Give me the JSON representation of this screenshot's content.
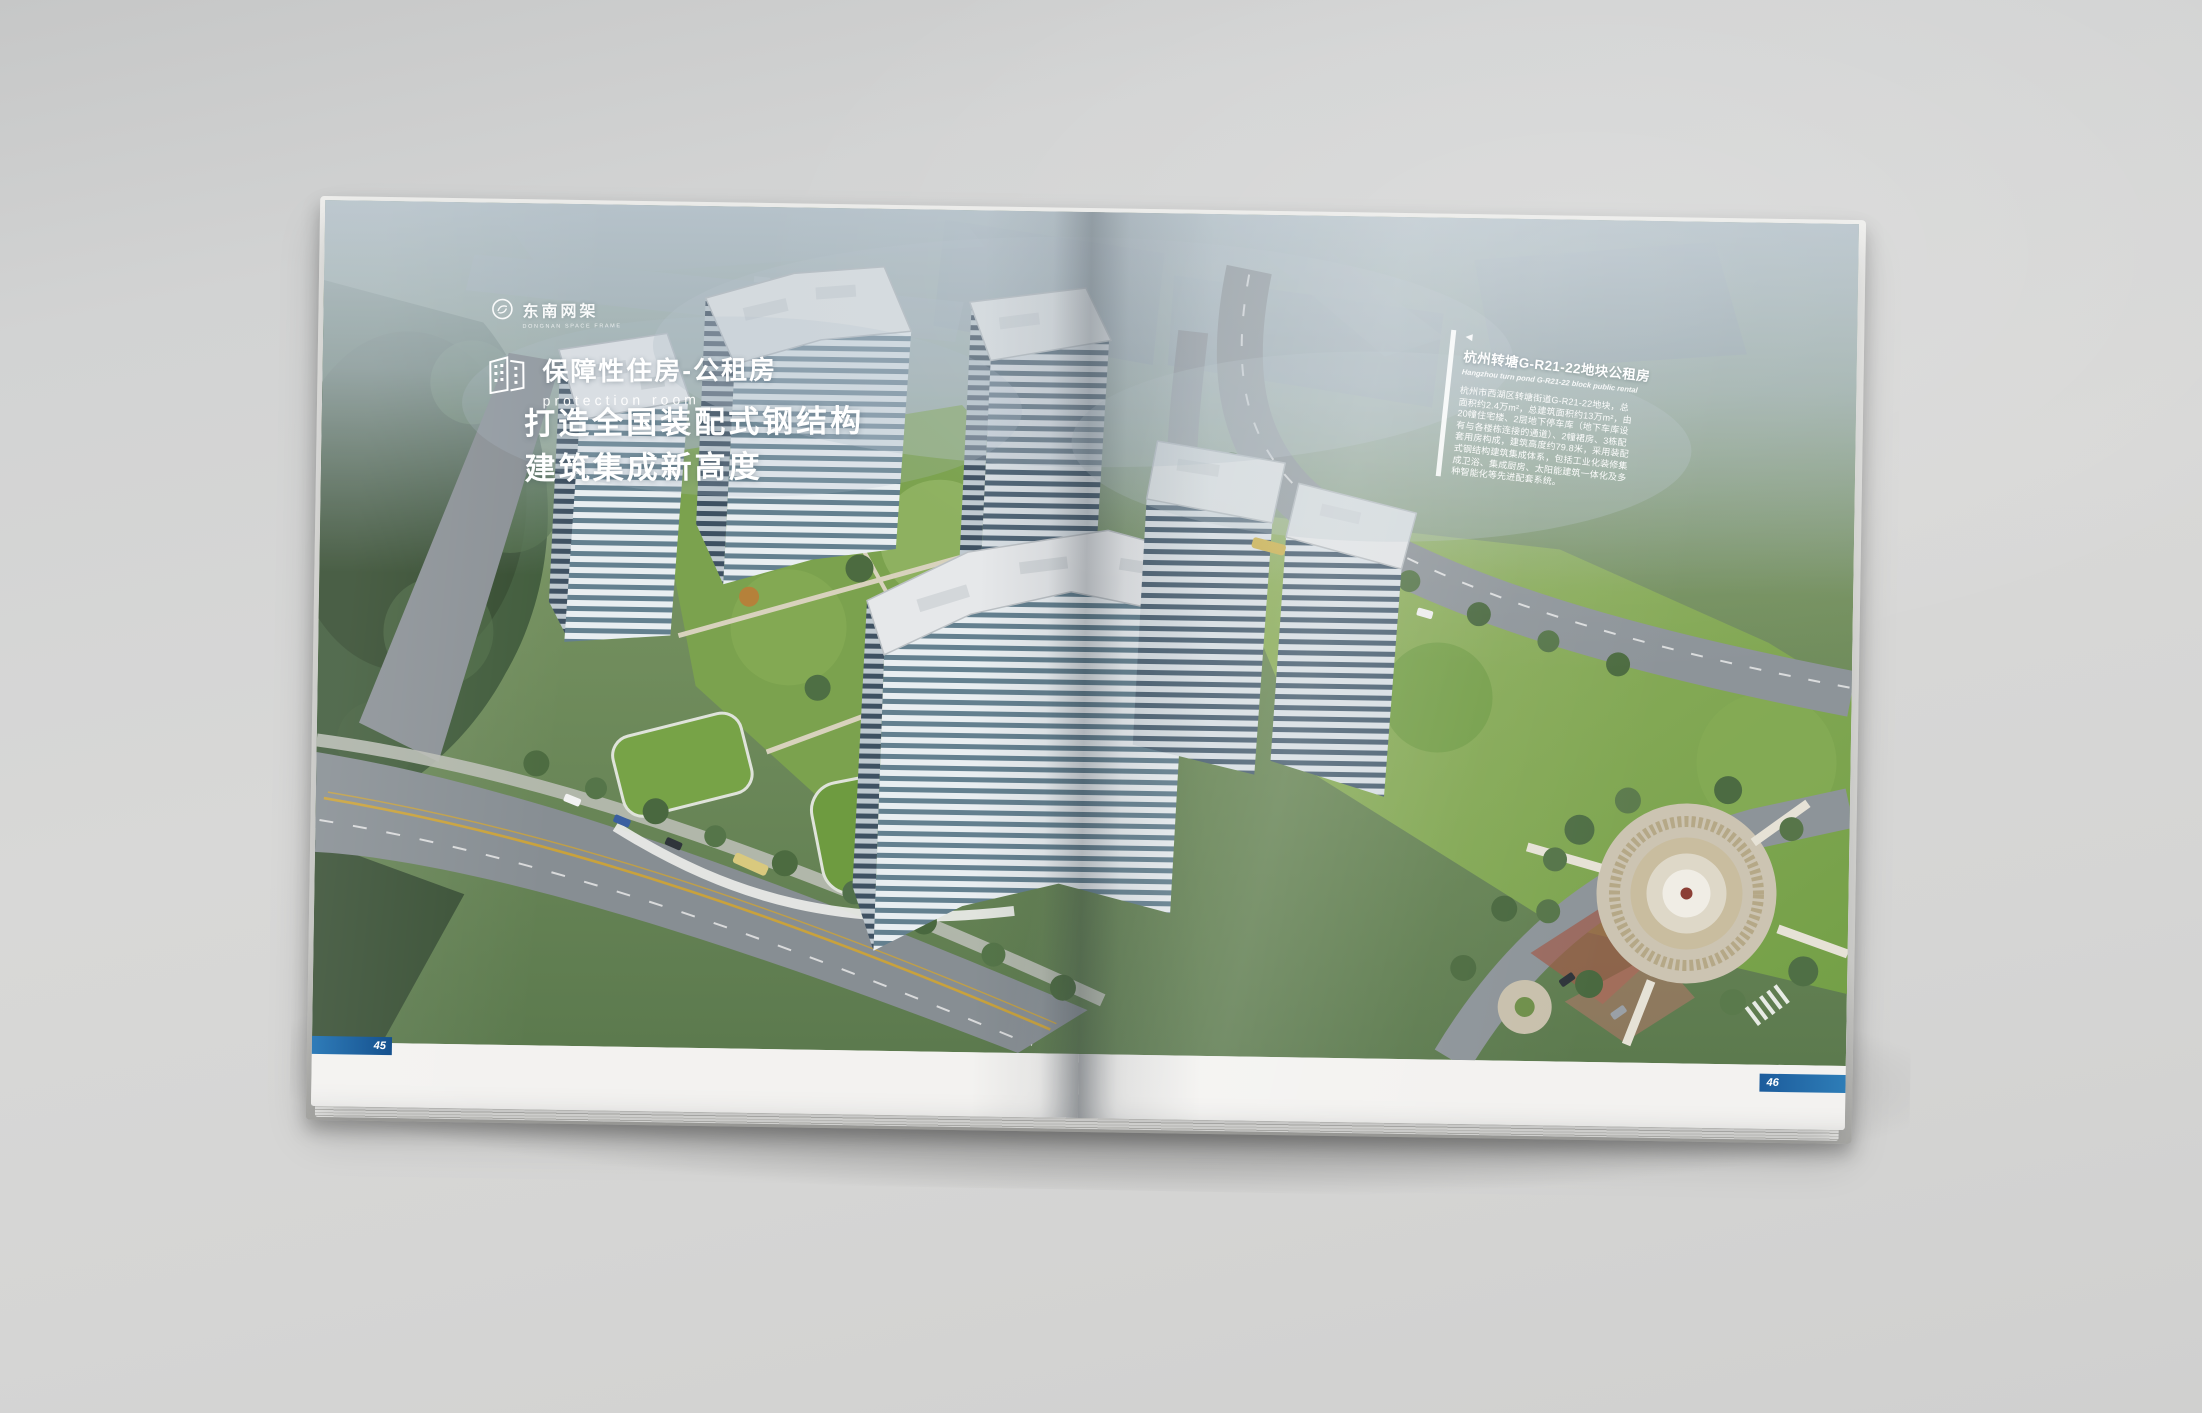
{
  "left_page": {
    "logo": {
      "icon": "circle-monogram-icon",
      "name": "东南网架",
      "tagline": "DONGNAN SPACE FRAME"
    },
    "program": {
      "icon": "buildings-outline-icon",
      "title": "保障性住房-公租房",
      "subtitle": "protection room"
    },
    "headline": {
      "line1": "打造全国装配式钢结构",
      "line2": "建筑集成新高度"
    },
    "page_number": "45"
  },
  "right_page": {
    "panel": {
      "marker": "◀",
      "title": "杭州转塘G-R21-22地块公租房",
      "subtitle": "Hangzhou turn pond G-R21-22 block public rental",
      "body_lines": [
        "杭州市西湖区转塘街道G-R21-22地块，总",
        "面积约2.4万m²，总建筑面积约13万m²，由",
        "20幢住宅楼、2层地下停车库（地下车库设",
        "有与各楼栋连接的通道）、2幢裙房、3栋配",
        "套用房构成，建筑高度约79.8米，采用装配",
        "式钢结构建筑集成体系，包括工业化装修集",
        "成卫浴、集成厨房、太阳能建筑一体化及多",
        "种智能化等先进配套系统。"
      ]
    },
    "page_number": "46"
  },
  "palette": {
    "backdrop_gray": "#d2d3d3",
    "page_white": "#f3f2f0",
    "bar_blue_left": "#15518e",
    "bar_blue_right": "#2e7db7",
    "fog_blue": "#b3c0c9",
    "forest_green": "#3d5638",
    "lawn_green": "#7ba24e",
    "road_gray": "#8b9196",
    "roof_gray": "#e3e6e8",
    "facade_blue": "#647e91",
    "autumn_accent": "#b5813a"
  }
}
